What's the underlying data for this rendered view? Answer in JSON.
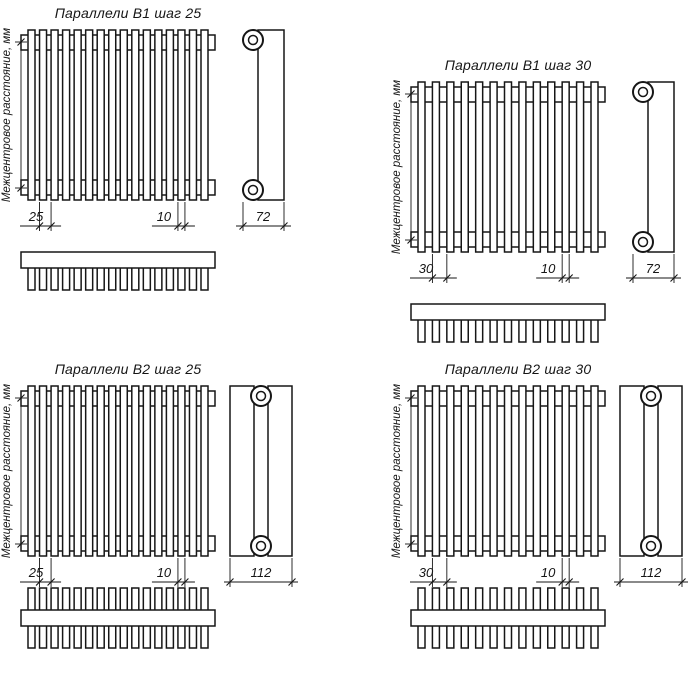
{
  "drawing": {
    "background": "#ffffff",
    "line_color": "#161616",
    "vertical_dim_label": "Межцентровое расстояние, мм",
    "panels": [
      {
        "id": "b1_step25",
        "title": "Параллели В1 шаг 25",
        "series": "B1",
        "rows": 1,
        "tube_count": 16,
        "pitch_mm": "25",
        "tube_width_mm": "10",
        "depth_mm": "72"
      },
      {
        "id": "b1_step30",
        "title": "Параллели В1 шаг 30",
        "series": "B1",
        "rows": 1,
        "tube_count": 13,
        "pitch_mm": "30",
        "tube_width_mm": "10",
        "depth_mm": "72"
      },
      {
        "id": "b2_step25",
        "title": "Параллели В2 шаг 25",
        "series": "B2",
        "rows": 2,
        "tube_count": 16,
        "pitch_mm": "25",
        "tube_width_mm": "10",
        "depth_mm": "112"
      },
      {
        "id": "b2_step30",
        "title": "Параллели В2 шаг 30",
        "series": "B2",
        "rows": 2,
        "tube_count": 13,
        "pitch_mm": "30",
        "tube_width_mm": "10",
        "depth_mm": "112"
      }
    ]
  }
}
